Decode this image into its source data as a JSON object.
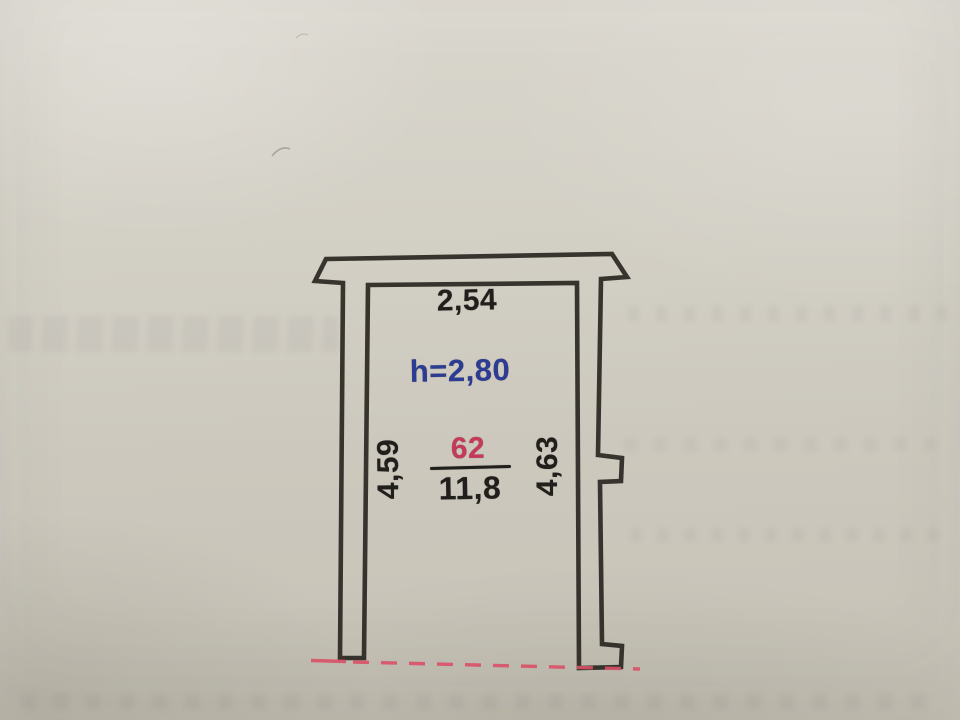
{
  "plan": {
    "labels": {
      "top_width": "2,54",
      "ceiling_height": "h=2,80",
      "unit_number": "62",
      "area": "11,8",
      "left_length": "4,59",
      "right_length": "4,63"
    },
    "colors": {
      "wall_ink": "#2e2b26",
      "dimension_text": "#211f1b",
      "height_text": "#2c3c92",
      "unit_number_text": "#c43a57",
      "boundary_line": "#d95067"
    }
  }
}
